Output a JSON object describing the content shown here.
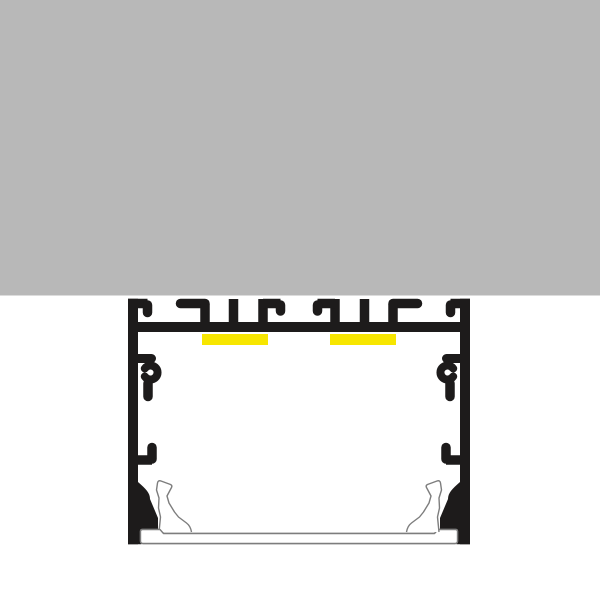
{
  "scene": {
    "type": "technical-cross-section-diagram",
    "subject": "surface-mounted aluminium LED profile with two LED strips and snap-in diffuser cover",
    "parts": {
      "mounting_surface": "ceiling-surface",
      "profile_body": "aluminium-profile-extrusion",
      "led_strips": [
        "led-strip-left",
        "led-strip-right"
      ],
      "diffuser": "diffuser-cover",
      "screw_channels": "end-cap-screw-ports",
      "mounting_slots": "bracket-t-slots"
    }
  },
  "colors": {
    "background": "#ffffff",
    "surface_gray": "#b8b8b8",
    "profile_black": "#1d1b1b",
    "led_yellow": "#f7e600",
    "diffuser_outline": "#7d7d7d",
    "diffuser_fill": "#ffffff"
  }
}
